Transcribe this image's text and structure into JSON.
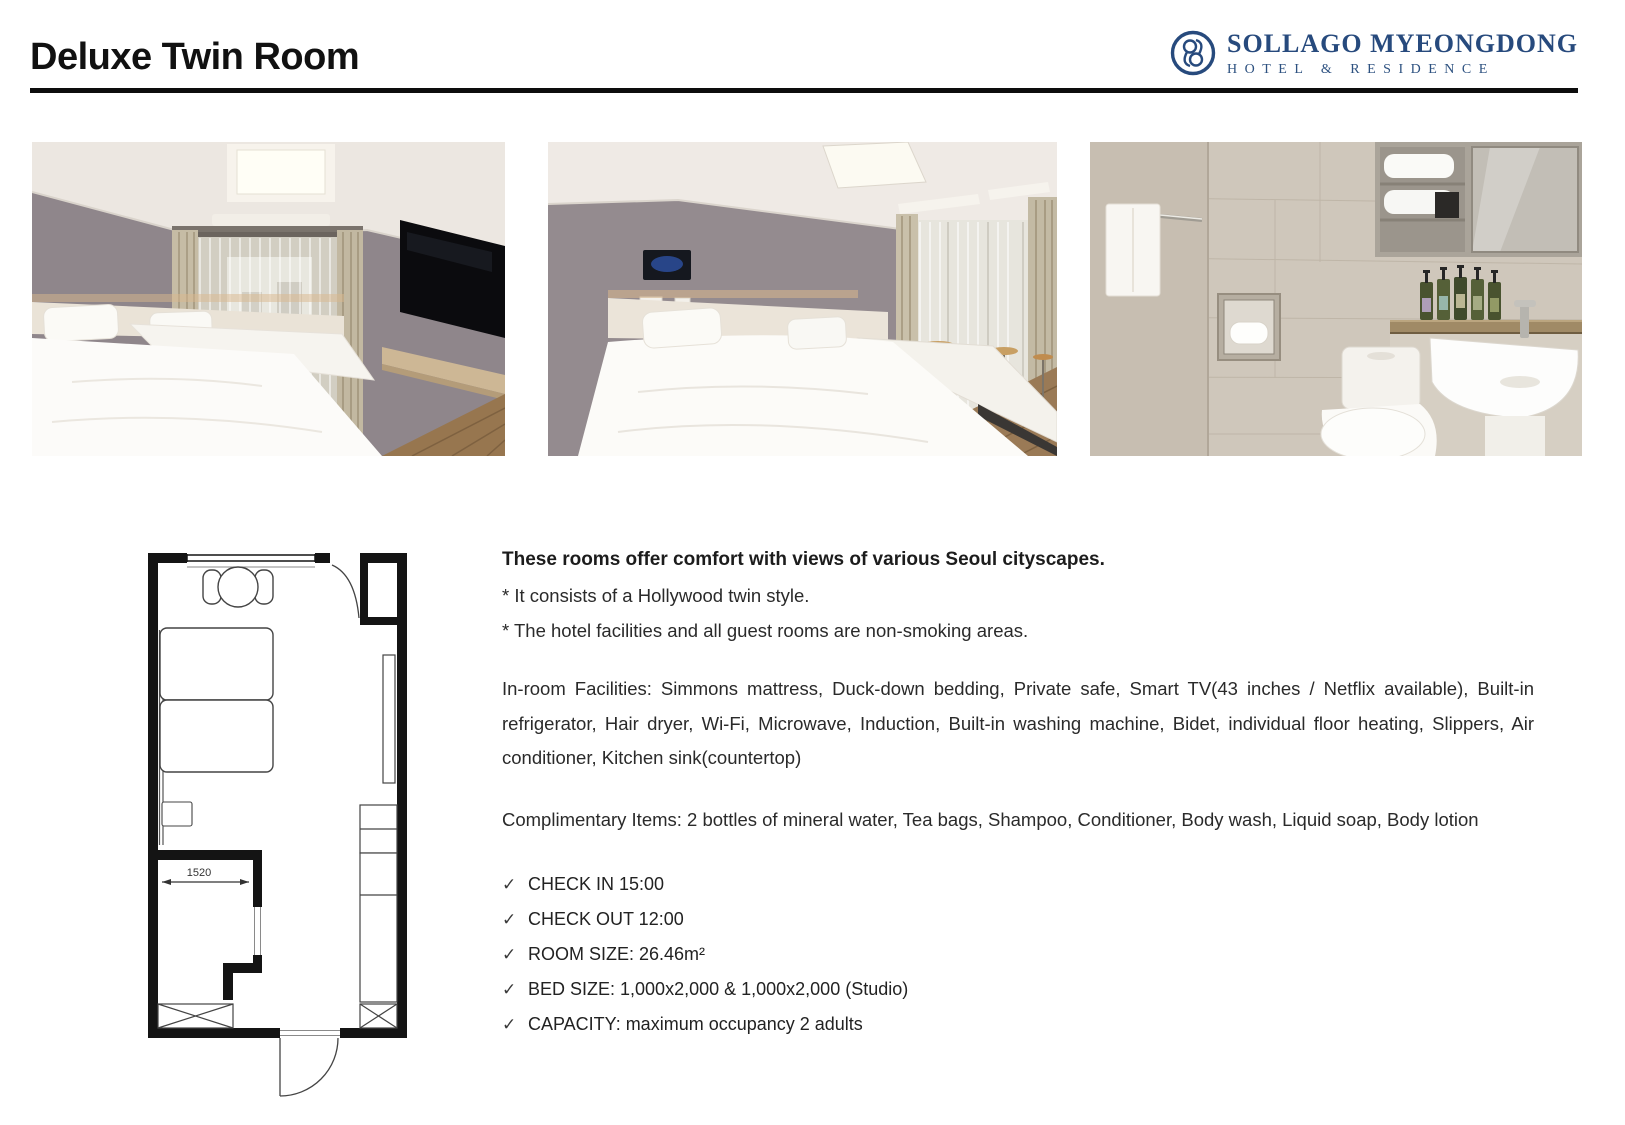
{
  "header": {
    "title": "Deluxe Twin Room",
    "logo": {
      "name": "SOLLAGO MYEONGDONG",
      "subtitle": "HOTEL & RESIDENCE",
      "color": "#274a7d"
    }
  },
  "photos": [
    {
      "label": "bedroom-photo-1"
    },
    {
      "label": "bedroom-photo-2"
    },
    {
      "label": "bathroom-photo"
    }
  ],
  "floor_plan": {
    "dimension_label": "1520"
  },
  "description": {
    "headline": "These rooms offer comfort with views of various Seoul cityscapes.",
    "notes": [
      "* It consists of a Hollywood twin style.",
      "* The hotel facilities and all guest rooms are non-smoking areas."
    ],
    "facilities": "In-room Facilities: Simmons mattress, Duck-down bedding, Private safe, Smart TV(43 inches / Netflix available), Built-in refrigerator, Hair dryer, Wi-Fi, Microwave, Induction, Built-in washing machine, Bidet, individual floor heating, Slippers, Air conditioner, Kitchen sink(countertop)",
    "complimentary": "Complimentary Items: 2 bottles of mineral water, Tea bags, Shampoo, Conditioner, Body wash, Liquid soap, Body lotion",
    "check_icon": "✓",
    "checklist": [
      "CHECK IN 15:00",
      "CHECK OUT 12:00",
      "ROOM SIZE: 26.46m²",
      "BED SIZE: 1,000x2,000 & 1,000x2,000 (Studio)",
      "CAPACITY: maximum occupancy 2 adults"
    ]
  }
}
